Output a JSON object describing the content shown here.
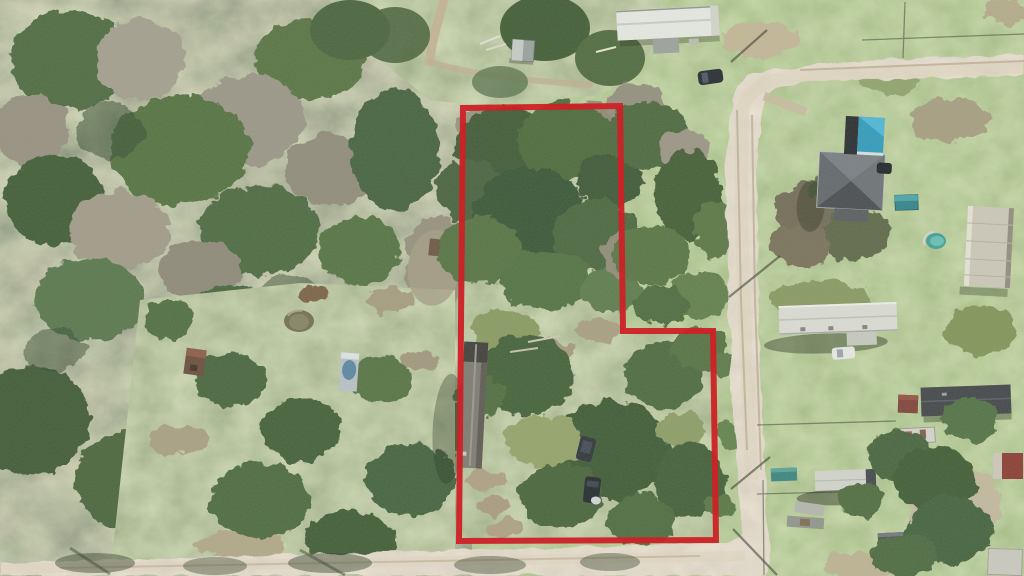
{
  "meta": {
    "title": "Aerial drone photograph of rural property with outlined parcel",
    "image_type": "aerial-photograph",
    "width_px": 1024,
    "height_px": 576,
    "visible_text": "none"
  },
  "boundary": {
    "color": "#ce2127",
    "stroke_width": 6,
    "svg_points": "463,108 620,106 623,331 713,331 716,540 459,541",
    "shape": "L-shaped parcel outline (rectangle with step-out on lower right)",
    "label": "Red property boundary"
  },
  "features": {
    "parcel": "Wooded parcel outlined in red",
    "forest": "Dense leafless and evergreen forest, west side",
    "clearing": "Grassy clearing with pond, small shed and parked camper",
    "pond": "Small murky pond",
    "barn": "Long gray-roof outbuilding inside parcel",
    "vehicles": "Two dark vehicles parked inside parcel",
    "road": "Light tan dirt road running along east side and bottom",
    "north_mobile_home": "Long white mobile home, top of frame",
    "north_shed": "Small gray shed near top path",
    "black_car": "Dark SUV parked by road, top",
    "hip_house": "Gray hip-roof house, east side",
    "teal_garage": "Teal gable-roof garage beside house",
    "teal_shed": "Small teal shed",
    "pool": "Small round pool",
    "vertical_mobile_home": "Tan mobile home oriented north-south, far east",
    "east_mobile_home": "Long white mobile home with dark shadow, east side",
    "white_car": "White car parked by east mobile home",
    "se_building": "Dark charcoal-roof building, southeast",
    "red_shed": "Small rust-red shed, southeast",
    "trailers": "Assorted utility trailers and campers, southeast yards",
    "pole_shadows": "Utility pole and wire shadows crossing the dirt road",
    "fences": "Thin fence lines between east-side yards"
  },
  "palette": {
    "road": "#cfc2a9",
    "lawn": "#74904f",
    "forest_base": "#7a7a62",
    "canopy_dark": "#3f5c35",
    "clearing": "#7e8a57",
    "boundary_red": "#ce2127",
    "roof_white": "#e7e9e3",
    "roof_teal": "#2d9abc",
    "roof_charcoal": "#3f4346"
  }
}
